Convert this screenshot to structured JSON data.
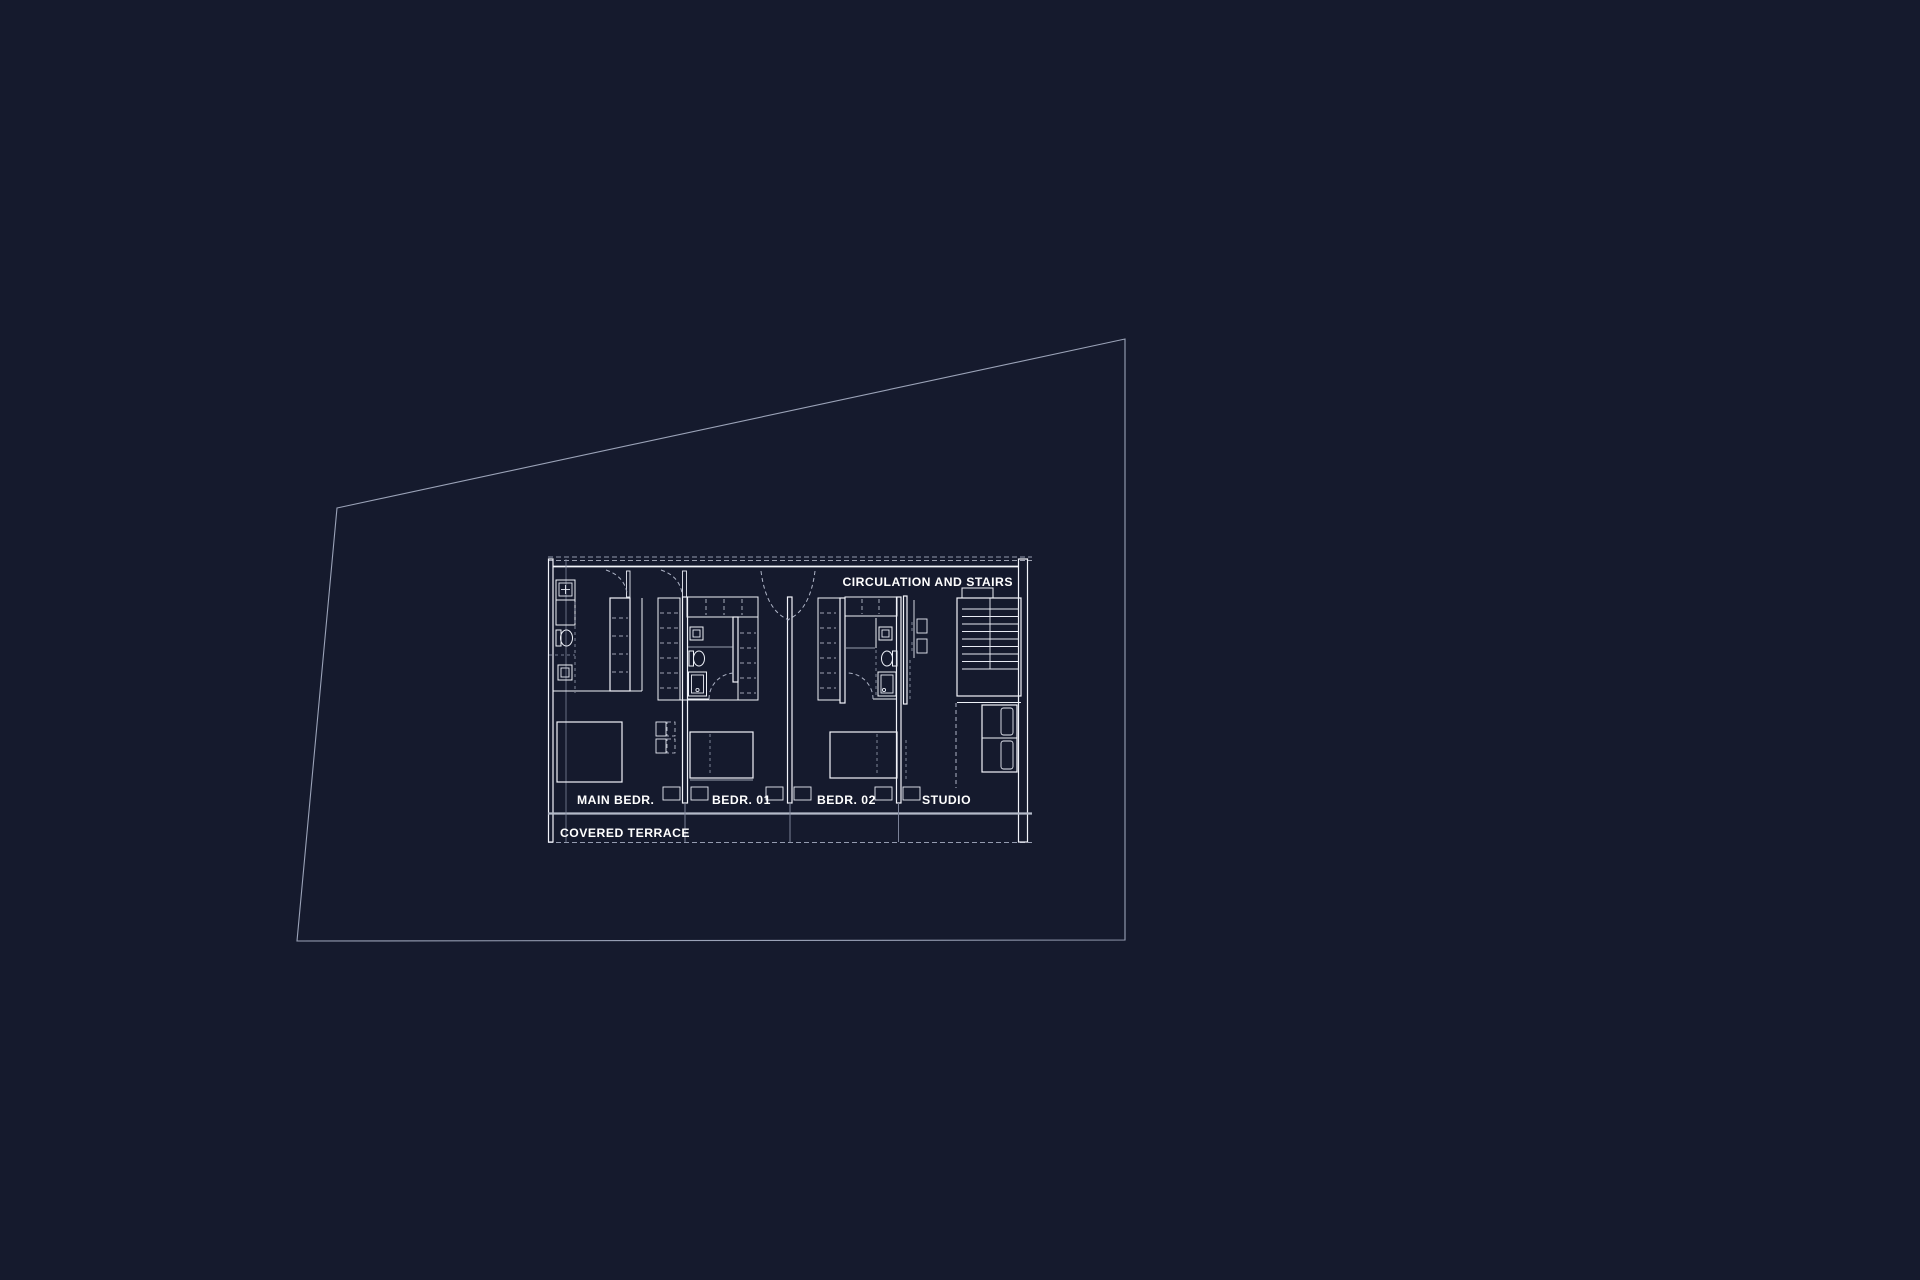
{
  "colors": {
    "background": "#151a2d",
    "drawing_line": "#eef1f8",
    "muted_line": "#9ba3b8",
    "text": "#ffffff"
  },
  "floor_plan": {
    "labels": {
      "circulation": "CIRCULATION AND STAIRS",
      "main_bedroom": "MAIN BEDR.",
      "bedroom_01": "BEDR. 01",
      "bedroom_02": "BEDR. 02",
      "studio": "STUDIO",
      "covered_terrace": "COVERED TERRACE"
    }
  }
}
